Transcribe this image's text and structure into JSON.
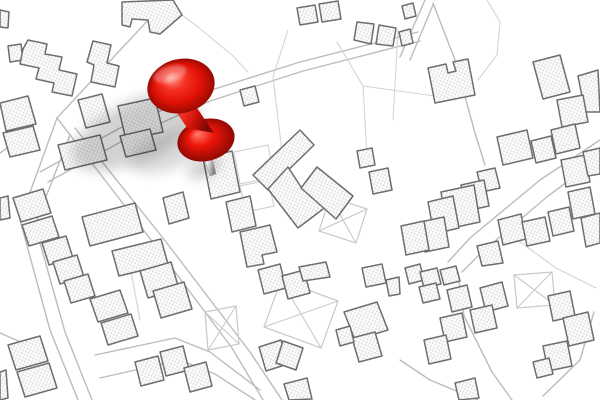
{
  "scene": {
    "label": "Cadastral city map with red push pin marker",
    "width": 600,
    "height": 400,
    "background": "#ffffff"
  },
  "colors": {
    "road": "#bcbcbc",
    "boundary": "#d4d4d4",
    "outline": "#6e6e6e",
    "hatch": "#b4b4b4",
    "xparcel": "#c9c9c9",
    "shadow": "#111111",
    "pin_red": "#ee1409"
  },
  "map": {
    "buildings": [
      "0,10 9,12 8,28 0,27",
      "8,46 21,44 23,60 10,62",
      "28,40 47,44 45,54 62,57 59,70 77,74 72,96 52,92 54,83 36,79 39,68 20,64 23,49",
      "93,41 111,45 107,63 119,66 115,87 91,82 94,65 87,62",
      "122,2 173,0 182,15 160,34 150,32 148,20 132,19 130,27 122,25",
      "0,103 28,96 36,124 6,131",
      "3,133 33,126 40,150 10,157",
      "78,100 102,94 110,122 86,128",
      "118,106 155,98 163,132 126,140",
      "58,145 100,135 107,160 65,170",
      "120,136 150,129 156,150 126,157",
      "0,198 8,196 10,218 0,220",
      "163,198 183,192 189,218 169,224",
      "203,158 232,151 240,192 211,199",
      "297,8 315,5 318,22 300,25",
      "319,4 338,1 341,19 322,22",
      "240,90 255,86 259,102 244,106",
      "357,22 374,24 371,44 354,40",
      "379,25 396,28 393,46 376,44",
      "402,6 413,3 416,16 405,19",
      "399,32 410,29 413,43 402,46",
      "428,68 446,64 448,73 456,71 453,62 468,59 475,95 435,103",
      "533,62 560,55 570,92 543,99",
      "578,76 598,70 600,112 585,112",
      "557,100 583,95 588,122 562,127",
      "300,130 314,145 268,190 253,175",
      "268,189 288,167 301,187 327,206 298,228",
      "317,167 353,196 336,219 301,188",
      "226,202 250,196 256,226 232,232",
      "240,232 270,225 277,252 262,255 264,264 247,267",
      "369,172 388,168 392,190 373,194",
      "357,151 372,148 375,165 360,168",
      "497,137 527,130 533,158 503,165",
      "531,141 551,136 556,158 536,163",
      "551,130 575,124 580,148 556,154",
      "477,172 495,168 500,188 482,192",
      "461,185 484,180 489,206 466,211",
      "441,192 474,185 480,222 447,229",
      "428,202 453,196 459,228 434,234",
      "420,222 444,217 449,247 425,252",
      "401,226 424,221 429,250 406,255",
      "498,220 521,214 526,239 503,245",
      "522,222 545,217 550,241 527,246",
      "548,212 569,207 574,231 553,236",
      "568,192 590,187 595,214 573,219",
      "561,160 585,155 590,182 566,187",
      "583,152 600,148 600,174 588,176",
      "581,218 600,213 600,243 586,247",
      "477,246 498,241 503,263 482,266",
      "13,198 43,189 51,213 21,222",
      "22,225 52,216 59,237 29,246",
      "42,243 66,236 73,258 49,265",
      "53,262 77,255 84,277 60,284",
      "64,281 88,274 95,296 71,303",
      "90,299 120,290 128,313 98,322",
      "101,323 131,314 138,336 108,345",
      "82,217 135,203 143,232 90,246",
      "112,251 161,239 168,264 119,276",
      "140,271 171,262 179,289 148,298",
      "153,291 184,282 192,309 161,318",
      "135,362 158,356 164,380 141,386",
      "160,352 183,346 189,370 166,376",
      "184,368 206,362 212,386 190,392",
      "8,345 40,336 48,361 16,370",
      "17,372 49,363 57,388 25,397",
      "0,372 6,370 8,398 0,400",
      "258,270 280,264 286,288 264,294",
      "282,276 304,270 310,293 288,299",
      "299,267 326,262 330,277 303,281",
      "362,268 382,264 386,283 366,287",
      "386,280 399,277 400,294 389,296",
      "259,347 281,340 288,364 266,371",
      "283,341 303,348 296,370 276,363",
      "284,384 307,378 312,399 289,400",
      "344,312 377,302 388,330 355,340",
      "352,338 375,332 382,356 359,362",
      "336,330 350,326 354,342 340,346",
      "405,268 420,264 424,280 409,284",
      "420,272 437,268 441,284 424,288",
      "440,270 456,266 460,281 444,285",
      "419,287 436,283 440,299 423,303",
      "447,290 467,285 472,307 452,312",
      "480,288 502,282 508,306 486,312",
      "470,310 492,305 497,328 475,333",
      "440,318 462,313 467,337 445,342",
      "424,340 446,335 451,359 429,364",
      "548,296 570,291 575,316 553,321",
      "563,318 588,312 594,340 569,346",
      "543,346 567,341 572,366 548,371",
      "533,362 549,358 553,374 537,378",
      "455,383 475,378 479,398 459,400"
    ],
    "roads": [
      "151,0 150,18 57,118",
      "57,118 145,232 232,348 263,400",
      "75,128 163,238 250,352 282,400",
      "57,118 20,220 50,330 78,400",
      "70,135 35,225 65,332 92,400",
      "40,172 120,128 205,92 300,62 418,32",
      "48,182 128,138 210,101 303,71 420,41",
      "400,57 425,0",
      "410,60 433,5",
      "433,3 455,60 475,133 485,165",
      "600,140 540,180 470,238 448,262",
      "600,158 548,196 482,252 462,272",
      "458,274 464,316 492,372 512,400",
      "95,355 175,338 210,352 260,390",
      "100,378 180,360 215,374 255,400",
      "543,396 580,360 594,312",
      "0,333 32,347",
      "28,133 0,153",
      "400,360 430,380 478,400"
    ],
    "boundaries": [
      "273,77 283,160",
      "288,30 273,77",
      "337,42 363,86 367,155",
      "363,86 435,96",
      "398,30 393,120",
      "487,0 500,22 497,55 478,80",
      "130,266 140,320",
      "512,236 556,268 596,288",
      "182,15 198,27 232,55 248,72"
    ],
    "plain_parcels": [
      "234,152 268,145 274,177 240,184",
      "240,186 268,180 274,206 246,212"
    ],
    "x_parcels": [
      "330,197 367,209 356,243 319,231",
      "281,280 338,301 321,348 264,327",
      "205,312 236,306 239,344 208,350",
      "514,275 552,272 555,305 517,308"
    ]
  },
  "shadows": [
    {
      "cx": 136,
      "cy": 131,
      "rx": 70,
      "ry": 30,
      "rot": -25,
      "opacity": 0.18
    },
    {
      "cx": 172,
      "cy": 150,
      "rx": 44,
      "ry": 18,
      "rot": -22,
      "opacity": 0.15
    },
    {
      "cx": 204,
      "cy": 168,
      "rx": 18,
      "ry": 8,
      "rot": -25,
      "opacity": 0.22
    }
  ],
  "pin": {
    "head": {
      "cx": 181,
      "cy": 86,
      "rx": 34,
      "ry": 27,
      "rot": -14,
      "stops": [
        [
          0,
          "#ff9e8e"
        ],
        [
          0.35,
          "#f53024"
        ],
        [
          0.7,
          "#e01105"
        ],
        [
          1,
          "#990b03"
        ]
      ]
    },
    "highlight": {
      "cx": 170,
      "cy": 74,
      "rx": 17,
      "ry": 8,
      "rot": -16,
      "opacity": 0.3
    },
    "neck": {
      "points": "168,99 195,105 214,133 187,128",
      "stops": [
        [
          0,
          "#8f0a03"
        ],
        [
          0.4,
          "#f03425"
        ],
        [
          0.7,
          "#cf1007"
        ],
        [
          1,
          "#7c0902"
        ]
      ]
    },
    "flange": {
      "cx": 206,
      "cy": 140,
      "rx": 29,
      "ry": 21,
      "rot": -14,
      "stops": [
        [
          0,
          "#ff7d6e"
        ],
        [
          0.45,
          "#ee1409"
        ],
        [
          1,
          "#8f0a03"
        ]
      ]
    },
    "needle": {
      "points": "202,151 210,149 216,174 210,176",
      "stops": [
        [
          0,
          "#c9c9c9"
        ],
        [
          0.45,
          "#f6f6f6"
        ],
        [
          1,
          "#838383"
        ]
      ]
    }
  }
}
